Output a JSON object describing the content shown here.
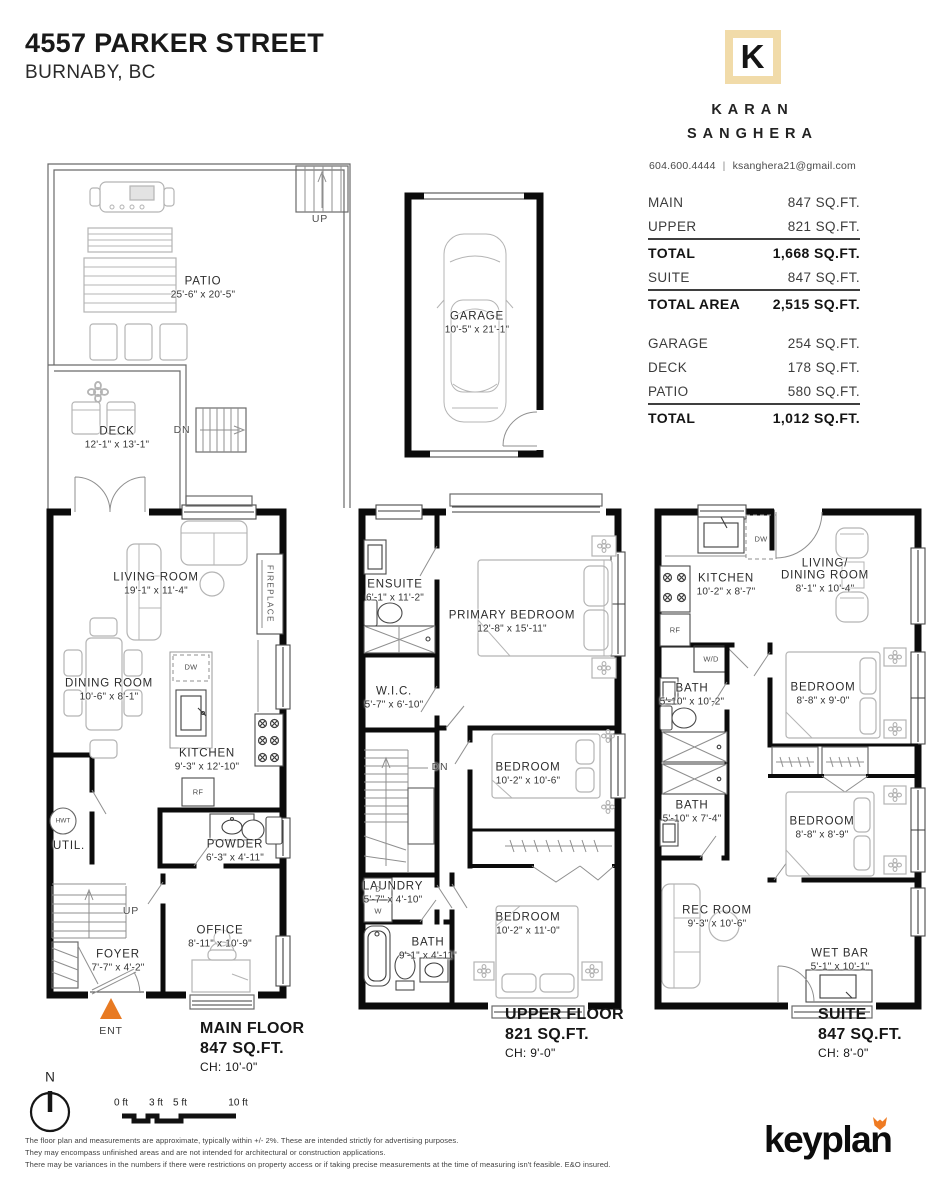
{
  "header": {
    "address": "4557 PARKER STREET",
    "city": "BURNABY, BC"
  },
  "agent": {
    "initial": "K",
    "first_name": "KARAN",
    "last_name": "SANGHERA",
    "phone": "604.600.4444",
    "separator": "|",
    "email": "ksanghera21@gmail.com"
  },
  "area_table": {
    "rows": [
      {
        "label": "MAIN",
        "value": "847 SQ.FT."
      },
      {
        "label": "UPPER",
        "value": "821 SQ.FT."
      },
      {
        "label": "TOTAL",
        "value": "1,668 SQ.FT."
      },
      {
        "label": "SUITE",
        "value": "847 SQ.FT."
      },
      {
        "label": "TOTAL AREA",
        "value": "2,515 SQ.FT."
      },
      {
        "label": "GARAGE",
        "value": "254 SQ.FT."
      },
      {
        "label": "DECK",
        "value": "178 SQ.FT."
      },
      {
        "label": "PATIO",
        "value": "580 SQ.FT."
      },
      {
        "label": "TOTAL",
        "value": "1,012 SQ.FT."
      }
    ]
  },
  "outdoor": {
    "patio": {
      "name": "PATIO",
      "dims": "25'-6\" x 20'-5\""
    },
    "deck": {
      "name": "DECK",
      "dims": "12'-1\" x 13'-1\""
    },
    "garage": {
      "name": "GARAGE",
      "dims": "10'-5\" x 21'-1\""
    },
    "up": "UP",
    "dn": "DN"
  },
  "plans": {
    "main": {
      "rooms": {
        "living": {
          "name": "LIVING ROOM",
          "dims": "19'-1\" x 11'-4\""
        },
        "dining": {
          "name": "DINING ROOM",
          "dims": "10'-6\" x 8'-1\""
        },
        "kitchen": {
          "name": "KITCHEN",
          "dims": "9'-3\" x 12'-10\""
        },
        "powder": {
          "name": "POWDER",
          "dims": "6'-3\" x 4'-11\""
        },
        "util": {
          "name": "UTIL."
        },
        "office": {
          "name": "OFFICE",
          "dims": "8'-11\" x 10'-9\""
        },
        "foyer": {
          "name": "FOYER",
          "dims": "7'-7\" x 4'-2\""
        }
      },
      "labels": {
        "fireplace": "FIREPLACE",
        "hwt": "HWT",
        "rf": "RF",
        "dw": "DW",
        "up": "UP",
        "ent": "ENT"
      },
      "floor": {
        "title": "MAIN FLOOR",
        "sqft": "847 SQ.FT.",
        "ch": "CH: 10'-0\""
      }
    },
    "upper": {
      "rooms": {
        "ensuite": {
          "name": "ENSUITE",
          "dims": "6'-1\" x 11'-2\""
        },
        "primary": {
          "name": "PRIMARY BEDROOM",
          "dims": "12'-8\" x 15'-11\""
        },
        "wic": {
          "name": "W.I.C.",
          "dims": "5'-7\" x 6'-10\""
        },
        "bedroom_mid": {
          "name": "BEDROOM",
          "dims": "10'-2\" x 10'-6\""
        },
        "laundry": {
          "name": "LAUNDRY",
          "dims": "5'-7\" x 4'-10\""
        },
        "bath": {
          "name": "BATH",
          "dims": "9'-1\" x 4'-11\""
        },
        "bedroom_bottom": {
          "name": "BEDROOM",
          "dims": "10'-2\" x 11'-0\""
        }
      },
      "labels": {
        "dn": "DN",
        "dryer": "D",
        "washer": "W"
      },
      "floor": {
        "title": "UPPER FLOOR",
        "sqft": "821 SQ.FT.",
        "ch": "CH: 9'-0\""
      }
    },
    "suite": {
      "rooms": {
        "kitchen": {
          "name": "KITCHEN",
          "dims": "10'-2\" x 8'-7\""
        },
        "living_dining": {
          "name_line1": "LIVING/",
          "name_line2": "DINING ROOM",
          "dims": "8'-1\" x 10'-4\""
        },
        "bath1": {
          "name": "BATH",
          "dims": "5'-10\" x 10'-2\""
        },
        "bedroom1": {
          "name": "BEDROOM",
          "dims": "8'-8\" x 9'-0\""
        },
        "bath2": {
          "name": "BATH",
          "dims": "5'-10\" x 7'-4\""
        },
        "bedroom2": {
          "name": "BEDROOM",
          "dims": "8'-8\" x 8'-9\""
        },
        "rec": {
          "name": "REC ROOM",
          "dims": "9'-3\" x 10'-6\""
        },
        "wetbar": {
          "name": "WET BAR",
          "dims": "5'-1\" x 10'-1\""
        }
      },
      "labels": {
        "wd": "W/D",
        "rf": "RF",
        "dw": "DW"
      },
      "floor": {
        "title": "SUITE",
        "sqft": "847 SQ.FT.",
        "ch": "CH: 8'-0\""
      }
    }
  },
  "compass": {
    "north": "N"
  },
  "scale_bar": {
    "t0": "0 ft",
    "t3": "3 ft",
    "t5": "5 ft",
    "t10": "10 ft"
  },
  "disclaimer": {
    "line1": "The floor plan and measurements are approximate, typically within +/- 2%. These are intended strictly for advertising purposes.",
    "line2": "They may encompass unfinished areas and are not intended for architectural or construction applications.",
    "line3": "There may be variances in the numbers if there were restrictions on property access or if taking precise measurements at the time of measuring isn't feasible. E&O insured."
  },
  "logo": {
    "text": "keyplan"
  },
  "colors": {
    "accent_tan": "#f1dba9",
    "accent_orange": "#e87a22",
    "wall": "#0b0b0b"
  }
}
